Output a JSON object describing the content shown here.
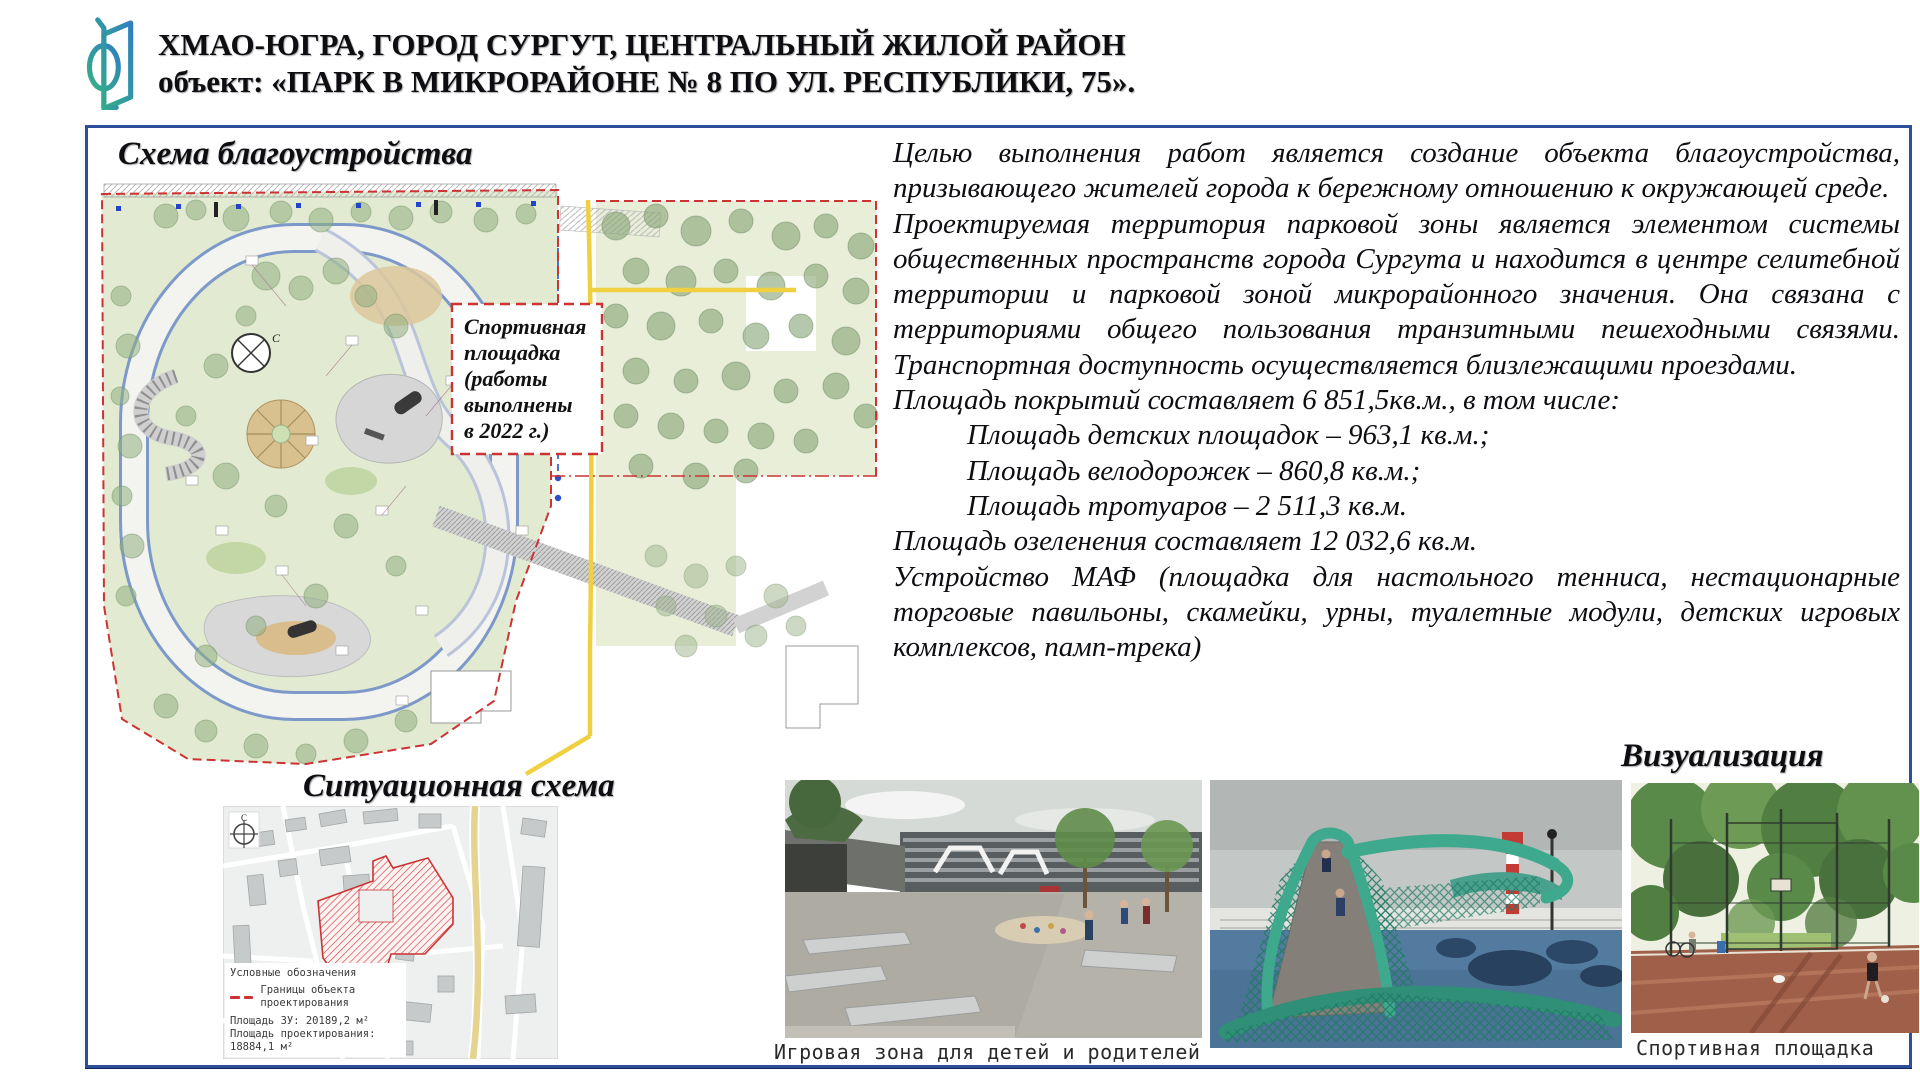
{
  "header": {
    "title_line1": "ХМАО-ЮГРА, ГОРОД СУРГУТ, ЦЕНТРАЛЬНЫЙ ЖИЛОЙ РАЙОН",
    "title_line2": "объект: «ПАРК В МИКРОРАЙОНЕ № 8 ПО УЛ. РЕСПУБЛИКИ, 75»."
  },
  "sections": {
    "plan_title": "Схема благоустройства",
    "situational_title": "Ситуационная схема",
    "visualization_title": "Визуализация"
  },
  "site_plan": {
    "sport_label_lines": [
      "Спортивная",
      "площадка",
      "(работы",
      "выполнены",
      "в 2022 г.)"
    ],
    "compass_letter": "С"
  },
  "description": {
    "p1": "Целью выполнения работ является создание объекта благоустройства, призывающего жителей города к бережному отношению к окружающей среде.",
    "p2": "Проектируемая территория парковой зоны является элементом системы общественных пространств города Сургута и находится в центре селитебной территории и парковой зоной микрорайонного значения. Она связана с территориями общего пользования транзитными пешеходными связями. Транспортная доступность осуществляется близлежащими проездами.",
    "area_intro": "Площадь покрытий составляет 6 851,5кв.м., в том числе:",
    "area_items": [
      "Площадь детских площадок – 963,1 кв.м.;",
      "Площадь велодорожек – 860,8 кв.м.;",
      "Площадь тротуаров – 2 511,3 кв.м."
    ],
    "greening": "Площадь озеленения составляет 12 032,6 кв.м.",
    "maf": "Устройство МАФ (площадка для настольного тенниса, нестационарные торговые павильоны, скамейки, урны, туалетные модули, детских игровых комплексов, памп-трека)"
  },
  "situational_map": {
    "legend_title": "Условные обозначения",
    "legend_boundary": "Границы объекта проектирования",
    "legend_area1": "Площадь ЗУ: 20189,2 м²",
    "legend_area2": "Площадь проектирования: 18884,1 м²",
    "compass_letter": "С"
  },
  "photos": {
    "play_caption": "Игровая зона для детей и родителей",
    "sport_caption": "Спортивная площадка"
  },
  "colors": {
    "panel_border": "#2d4e9b",
    "boundary_red": "#cc3333",
    "road_yellow": "#f0d040",
    "park_green": "#e2ebd1",
    "logo_green": "#35b283",
    "logo_blue": "#2f7fc1"
  }
}
